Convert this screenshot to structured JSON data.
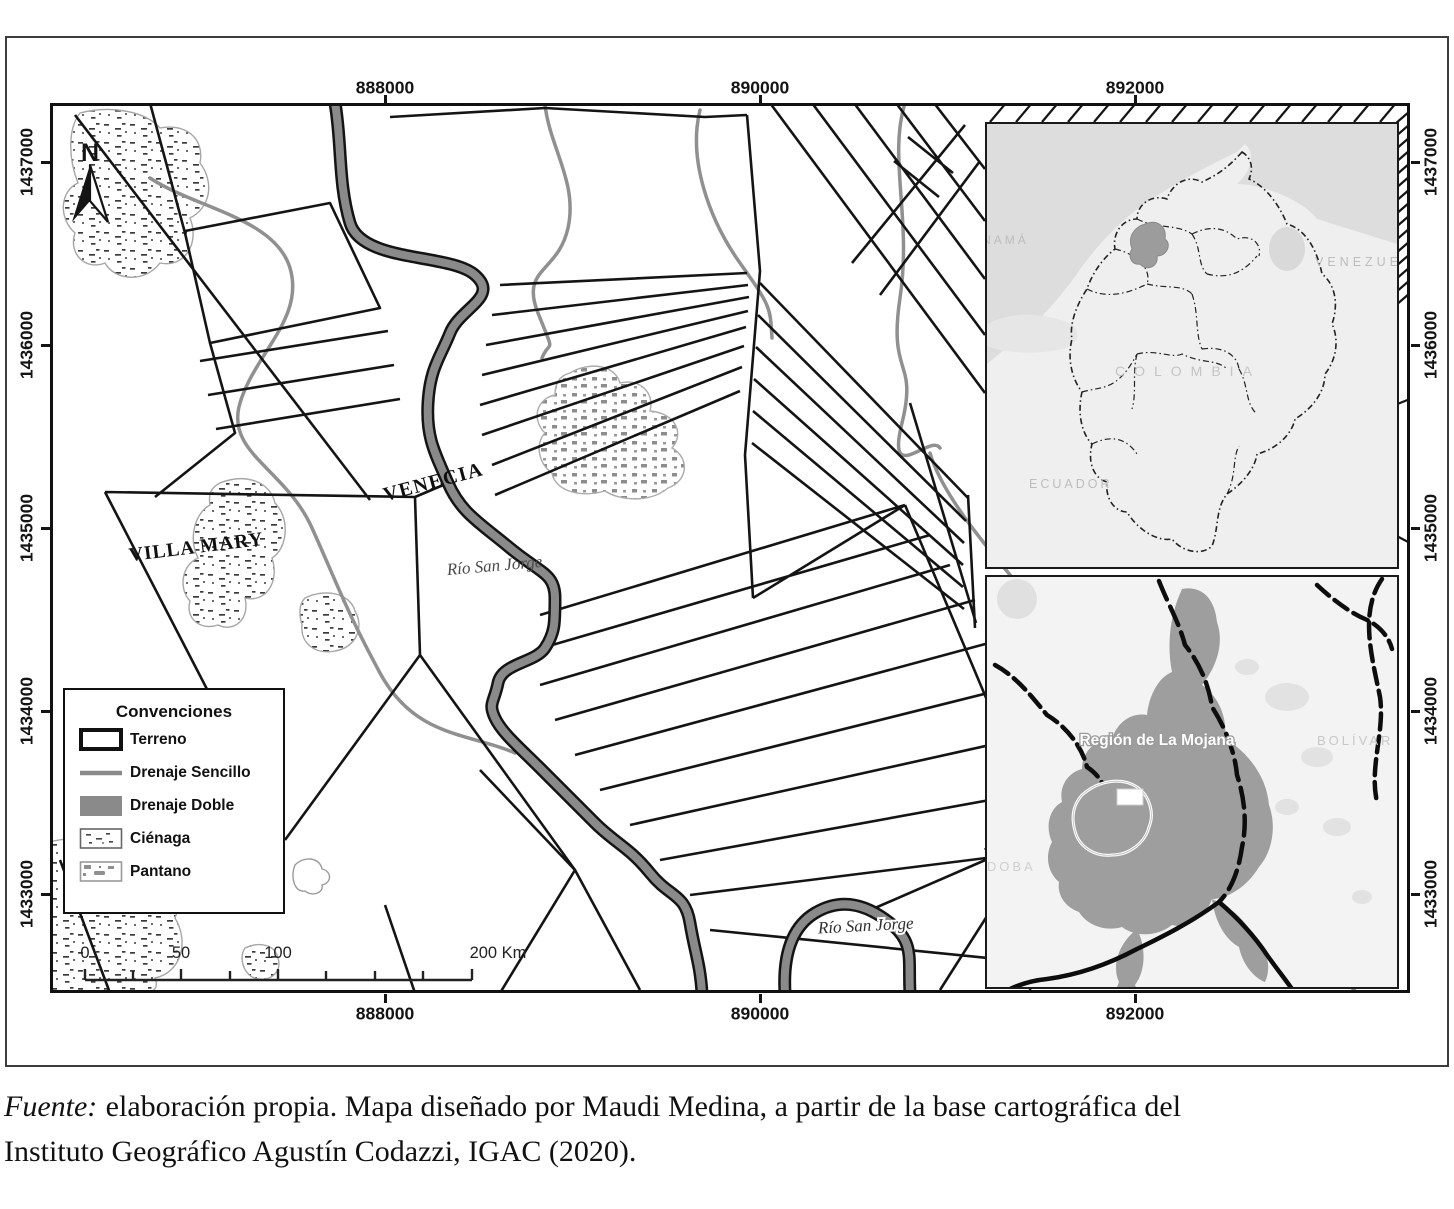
{
  "map": {
    "x_axis": {
      "ticks": [
        "888000",
        "890000",
        "892000"
      ]
    },
    "y_axis": {
      "ticks": [
        "1437000",
        "1436000",
        "1435000",
        "1434000",
        "1433000"
      ]
    },
    "north_label": "N",
    "place_labels": {
      "venecia": "VENECIA",
      "villa_mary": "VILLA MARY",
      "rio_san_jorge": "Río San Jorge",
      "rio_san_jorge_lower": "Río San Jorge"
    },
    "scale_bar": {
      "labels": [
        "0",
        "50",
        "100",
        "200 Km"
      ]
    }
  },
  "legend": {
    "title": "Convenciones",
    "items": [
      {
        "id": "terreno",
        "label": "Terreno"
      },
      {
        "id": "drenaje-sencillo",
        "label": "Drenaje Sencillo"
      },
      {
        "id": "drenaje-doble",
        "label": "Drenaje Doble"
      },
      {
        "id": "cienaga",
        "label": "Ciénaga"
      },
      {
        "id": "pantano",
        "label": "Pantano"
      }
    ]
  },
  "inset_colombia": {
    "labels": {
      "panama": "PANAMÁ",
      "venezuela": "VENEZUELA",
      "colombia": "COLOMBIA",
      "ecuador": "ECUADOR"
    }
  },
  "inset_mojana": {
    "labels": {
      "region": "Región de La Mojana",
      "bolivar": "BOLÍVAR",
      "cordoba": "CÓRDOBA"
    }
  },
  "caption": {
    "source_label": "Fuente:",
    "line1_rest": "elaboración propia. Mapa diseñado por Maudi Medina, a partir de la base cartográfica del",
    "line2": "Instituto Geográfico Agustín Codazzi, IGAC (2020)."
  },
  "colors": {
    "drainage_single": "#909090",
    "drainage_double": "#8a8a8a",
    "parcel_line": "#141414",
    "mojana_highlight": "#9e9e9e"
  }
}
